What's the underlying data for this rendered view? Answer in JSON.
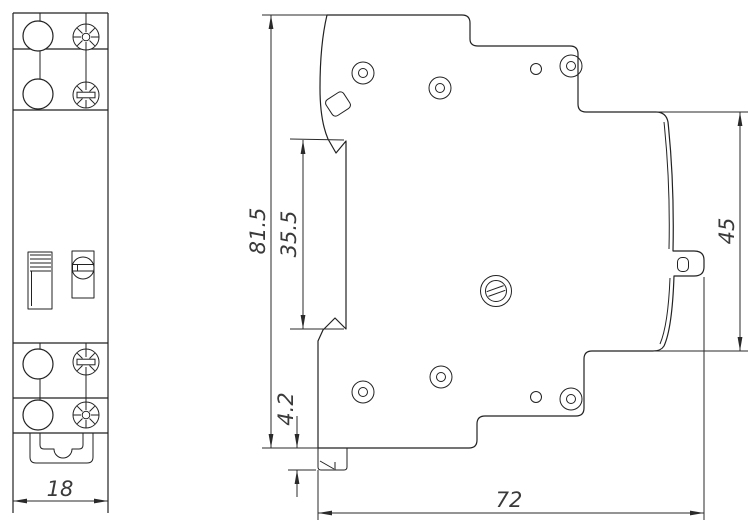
{
  "drawing": {
    "background_color": "#ffffff",
    "line_color": "#222222",
    "text_color": "#3a3a3a",
    "views": {
      "front": {
        "width_mm": "18"
      },
      "side": {
        "overall_height_mm": "81.5",
        "recess_height_mm": "35.5",
        "foot_offset_mm": "4.2",
        "rail_section_height_mm": "45",
        "depth_mm": "72"
      }
    }
  }
}
